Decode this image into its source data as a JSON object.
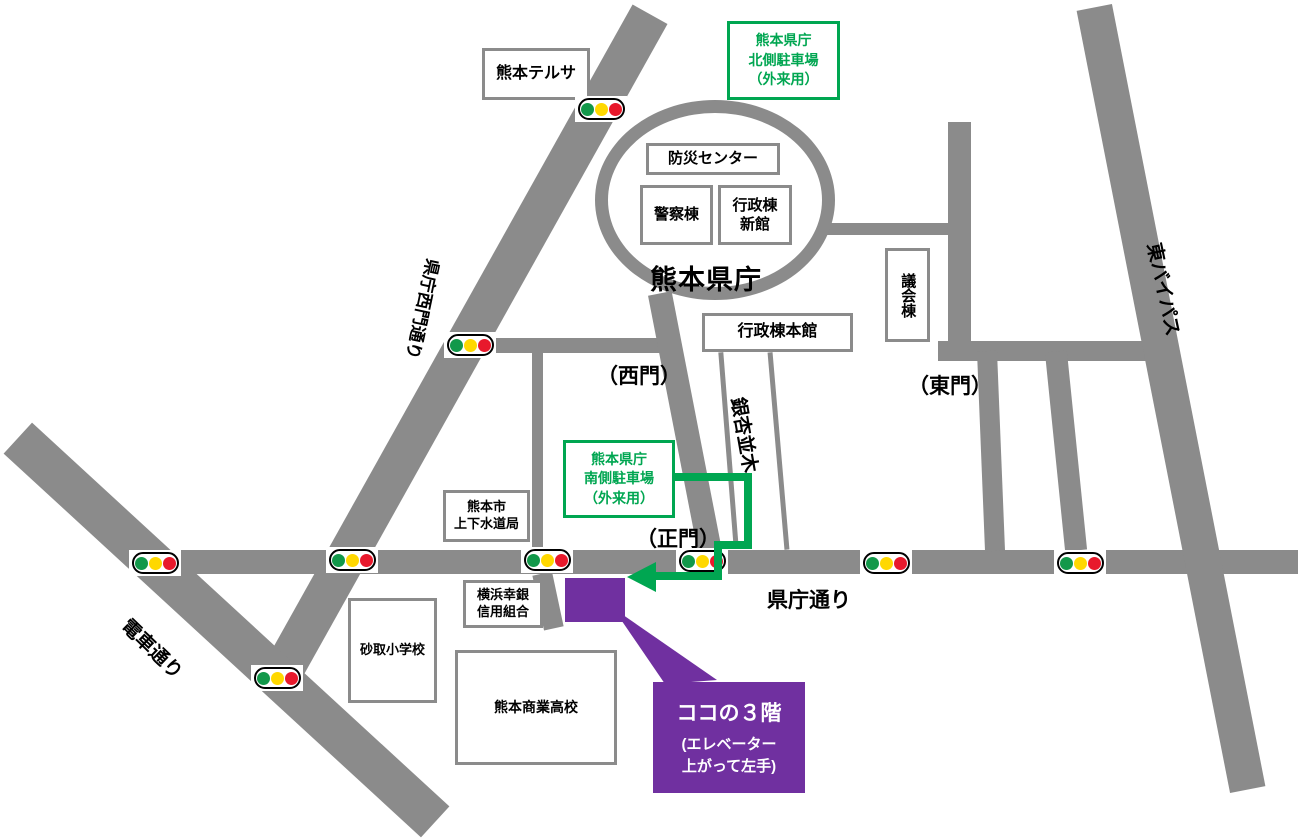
{
  "title": "熊本県庁周辺 案内図",
  "prefecture_label": "熊本県庁",
  "buildings": {
    "terrsa": {
      "lines": [
        "熊本テルサ"
      ]
    },
    "bousai": {
      "lines": [
        "防災センター"
      ]
    },
    "keisatsu": {
      "lines": [
        "警察棟"
      ]
    },
    "gyousei_shinkan": {
      "lines": [
        "行政棟",
        "新館"
      ]
    },
    "gyousei_honkan": {
      "lines": [
        "行政棟本館"
      ]
    },
    "gikai": {
      "lines": [
        "議会棟"
      ]
    },
    "suidou": {
      "lines": [
        "熊本市",
        "上下水道局"
      ]
    },
    "yokohama": {
      "lines": [
        "横浜幸銀",
        "信用組合"
      ]
    },
    "sunatori": {
      "lines": [
        "砂取小学校"
      ]
    },
    "shougyou": {
      "lines": [
        "熊本商業高校"
      ]
    }
  },
  "parking": {
    "north": {
      "lines": [
        "熊本県庁",
        "北側駐車場",
        "（外来用）"
      ]
    },
    "south": {
      "lines": [
        "熊本県庁",
        "南側駐車場",
        "（外来用）"
      ]
    }
  },
  "gates": {
    "west": "（西門）",
    "east": "（東門）",
    "main": "（正門）"
  },
  "roads": {
    "west_gate_street": "県庁西門通り",
    "densha_street": "電車通り",
    "kencho_street": "県庁通り",
    "higashi_bypass": "東バイパス",
    "ginkgo_avenue": "銀杏並木"
  },
  "destination": {
    "line1": "ココの３階",
    "line2": "(エレベーター",
    "line3": "上がって左手)"
  },
  "colors": {
    "road": "#8b8b8b",
    "route_green": "#00a651",
    "purple": "#7030a0",
    "signal_green": "#12984a",
    "signal_yellow": "#ffd800",
    "signal_red": "#e8192c"
  }
}
